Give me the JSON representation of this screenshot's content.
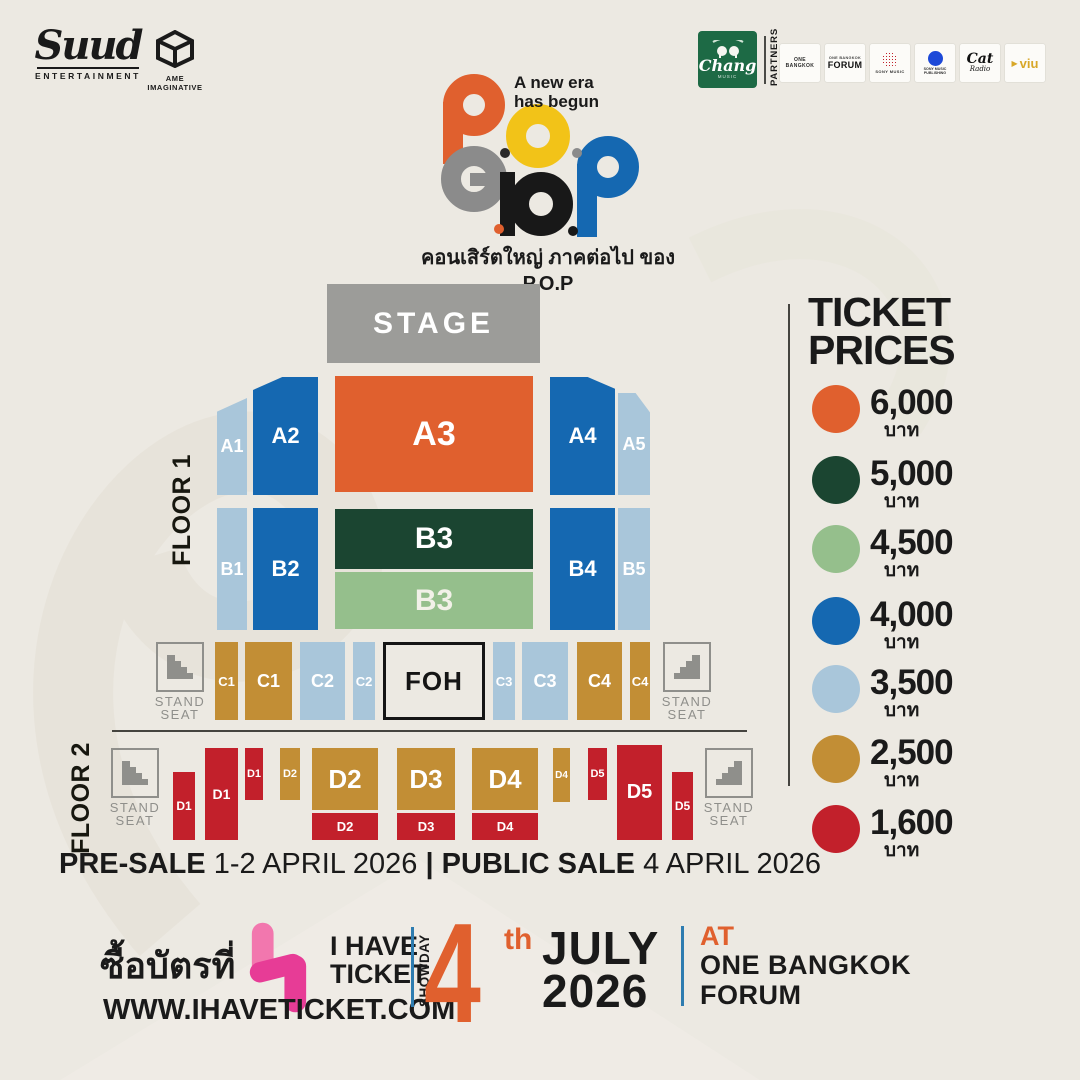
{
  "palette": {
    "orange": "#e0602e",
    "darkgreen": "#1b4531",
    "lightgreen": "#95bf8c",
    "blue": "#1568b1",
    "lightblue": "#a9c6da",
    "gold": "#c28e35",
    "red": "#c2202b",
    "stage_gray": "#9c9c99",
    "logo_gray": "#8b8b8b",
    "logo_yellow": "#f2c318",
    "logo_black": "#181818",
    "line_dark": "#45443f",
    "line_blue": "#2e7cb0",
    "pink_light": "#f277ae",
    "pink_dark": "#e73c96",
    "chang_green": "#1d6a45",
    "viu_gold": "#d8a728",
    "sony_blue": "#1d49d8"
  },
  "header": {
    "suud_name": "Suud",
    "suud_sub": "ENTERTAINMENT",
    "ame_label": "AME IMAGINATIVE",
    "partners_label": "PARTNERS",
    "chang_name": "Chang",
    "chang_sub": "MUSIC",
    "one_bangkok": "ONE BANGKOK",
    "forum_top": "ONE BANGKOK",
    "forum": "FORUM",
    "sony_music": "SONY MUSIC",
    "sony_publishing_1": "SONY MUSIC",
    "sony_publishing_2": "PUBLISHING",
    "cat": "Cat",
    "cat_radio": "Radio",
    "viu": "viu"
  },
  "icons": {
    "viu_play": "▶"
  },
  "logo": {
    "tagline_line1": "A new era",
    "tagline_line2": "has begun",
    "name": "P.O.P",
    "subtitle_thai": "คอนเสิร์ตใหญ่ ภาคต่อไป ของ P.O.P"
  },
  "map": {
    "stage": "STAGE",
    "floor1": "FLOOR 1",
    "floor2": "FLOOR 2",
    "foh": "FOH",
    "stand_line1": "STAND",
    "stand_line2": "SEAT",
    "sections": {
      "a1": "A1",
      "a2": "A2",
      "a3": "A3",
      "a4": "A4",
      "a5": "A5",
      "b1": "B1",
      "b2": "B2",
      "b3_upper": "B3",
      "b3_lower": "B3",
      "b4": "B4",
      "b5": "B5",
      "c1_narrow": "C1",
      "c1": "C1",
      "c2": "C2",
      "c2_narrow": "C2",
      "c3_narrow": "C3",
      "c3": "C3",
      "c4": "C4",
      "c4_narrow": "C4",
      "d1_low": "D1",
      "d1_tall": "D1",
      "d1_small": "D1",
      "d2_small": "D2",
      "d2": "D2",
      "d2_red": "D2",
      "d3": "D3",
      "d3_red": "D3",
      "d4": "D4",
      "d4_red": "D4",
      "d4_small": "D4",
      "d5_small": "D5",
      "d5_tall": "D5",
      "d5_low": "D5"
    }
  },
  "prices": {
    "title_line1": "TICKET",
    "title_line2": "PRICES",
    "currency": "บาท",
    "items": [
      {
        "price": "6,000",
        "color": "#e0602e"
      },
      {
        "price": "5,000",
        "color": "#1b4531"
      },
      {
        "price": "4,500",
        "color": "#95bf8c"
      },
      {
        "price": "4,000",
        "color": "#1568b1"
      },
      {
        "price": "3,500",
        "color": "#a9c6da"
      },
      {
        "price": "2,500",
        "color": "#c28e35"
      },
      {
        "price": "1,600",
        "color": "#c2202b"
      }
    ]
  },
  "sale": {
    "presale_label": "PRE-SALE",
    "presale_date": "1-2 APRIL 2026",
    "divider": "|",
    "public_label": "PUBLIC SALE",
    "public_date": "4 APRIL 2026"
  },
  "footer": {
    "buy_at_thai": "ซื้อบัตรที่",
    "brand_line1": "I HAVE",
    "brand_line2": "TICKET",
    "website": "WWW.IHAVETICKET.COM",
    "showday_label": "SHOWDAY",
    "day": "4",
    "ordinal": "th",
    "month": "JULY",
    "year": "2026",
    "at_label": "AT",
    "venue_line1": "ONE BANGKOK",
    "venue_line2": "FORUM"
  }
}
